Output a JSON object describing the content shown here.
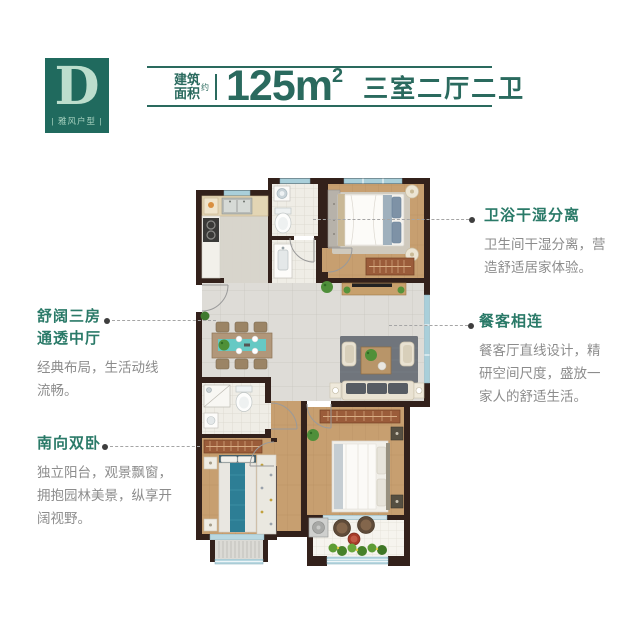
{
  "logo": {
    "letter": "D",
    "label": "| 雅风户型 |"
  },
  "header": {
    "area_label_top": "建筑",
    "area_label_bottom": "面积",
    "approx": "约",
    "area_value": "125",
    "area_unit": "m",
    "area_exponent": "2",
    "layout": "三室二厅二卫"
  },
  "annotations": {
    "hall": {
      "title_lines": [
        "舒阔三房",
        "通透中厅"
      ],
      "body_lines": [
        "经典布局，生活动线",
        "流畅。"
      ]
    },
    "south_bedrooms": {
      "title": "南向双卧",
      "body_lines": [
        "独立阳台，观景飘窗，",
        "拥抱园林美景，纵享开",
        "阔视野。"
      ]
    },
    "bath": {
      "title": "卫浴干湿分离",
      "body_lines": [
        "卫生间干湿分离，营",
        "造舒适居家体验。"
      ]
    },
    "dining": {
      "title": "餐客相连",
      "body_lines": [
        "餐客厅直线设计，精",
        "研空间尺度，盛放一",
        "家人的舒适生活。"
      ]
    }
  },
  "colors": {
    "teal_header": "#2a6a5e",
    "teal_title": "#2a7a68",
    "logo_bg": "#206a5e",
    "logo_text": "#bcdecd",
    "body_gray": "#8c8c8c",
    "wall": "#33211b",
    "window_blue": "#a9cfda",
    "wood_floor": "#c79f70",
    "tile_gray": "#dedcd7",
    "accent_teal_furniture": "#2d7e95"
  }
}
